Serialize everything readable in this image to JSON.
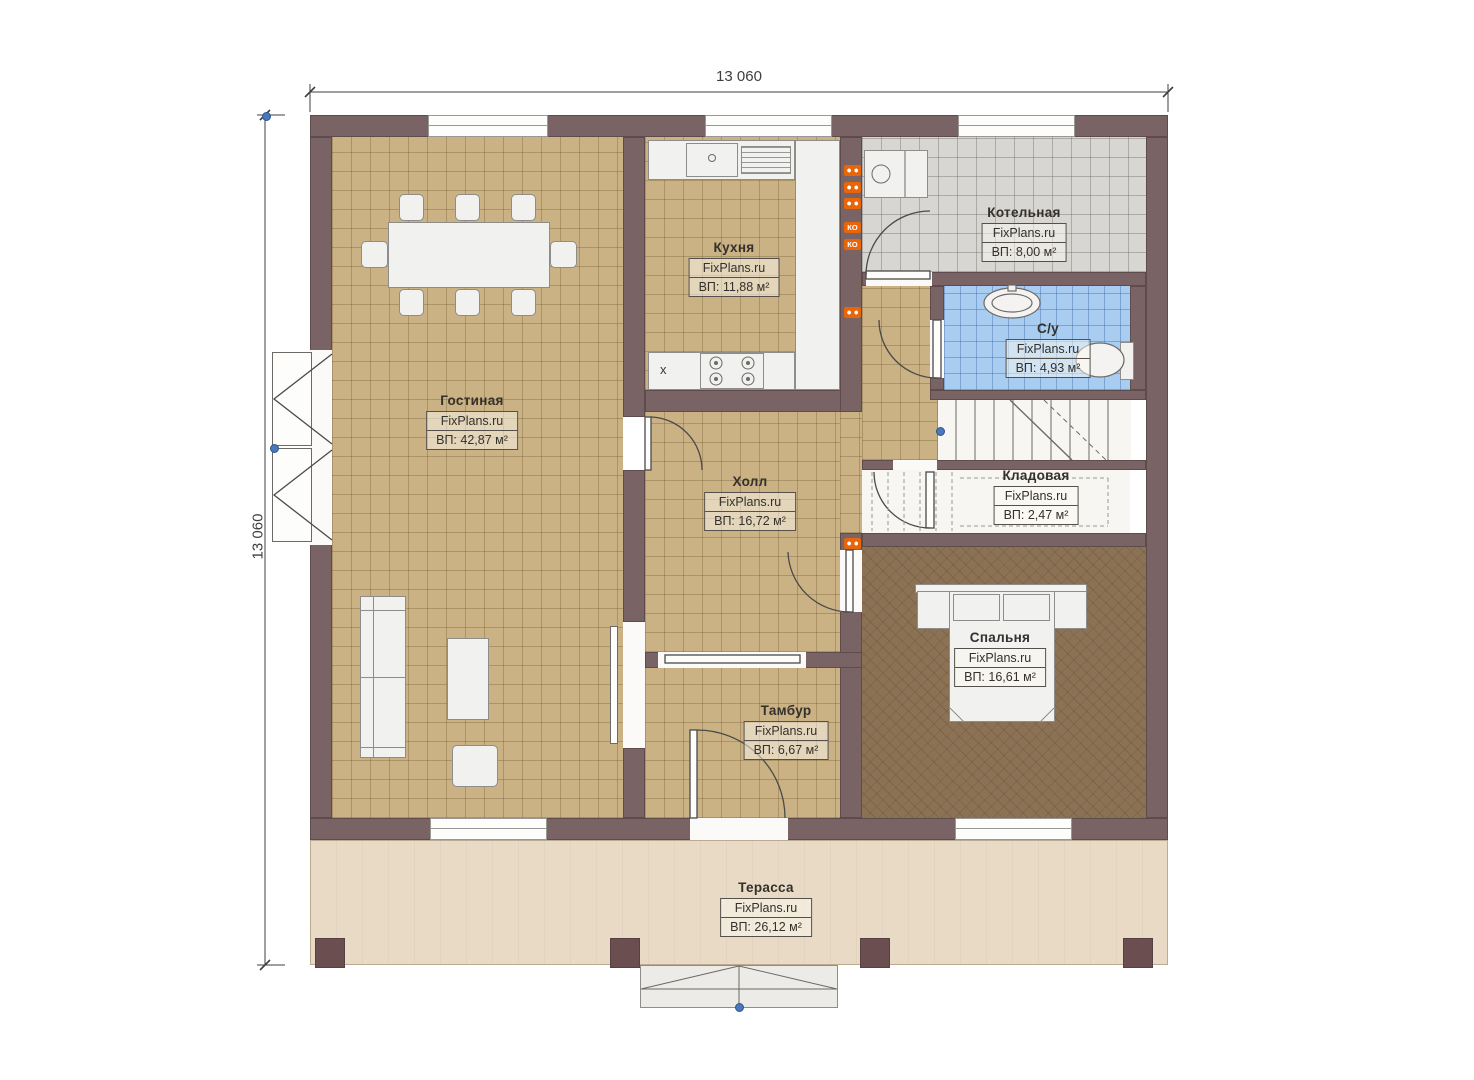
{
  "plan": {
    "dimensions": {
      "top": "13 060",
      "left": "13 060"
    },
    "rooms": [
      {
        "name": "Гостиная",
        "brand": "FixPlans.ru",
        "area": "ВП: 42,87 м²"
      },
      {
        "name": "Кухня",
        "brand": "FixPlans.ru",
        "area": "ВП: 11,88 м²"
      },
      {
        "name": "Котельная",
        "brand": "FixPlans.ru",
        "area": "ВП: 8,00 м²"
      },
      {
        "name": "С/у",
        "brand": "FixPlans.ru",
        "area": "ВП: 4,93 м²"
      },
      {
        "name": "Кладовая",
        "brand": "FixPlans.ru",
        "area": "ВП: 2,47 м²"
      },
      {
        "name": "Холл",
        "brand": "FixPlans.ru",
        "area": "ВП: 16,72 м²"
      },
      {
        "name": "Спальня",
        "brand": "FixPlans.ru",
        "area": "ВП: 16,61 м²"
      },
      {
        "name": "Тамбур",
        "brand": "FixPlans.ru",
        "area": "ВП: 6,67 м²"
      },
      {
        "name": "Терасса",
        "brand": "FixPlans.ru",
        "area": "ВП: 26,12 м²"
      }
    ],
    "annotations": {
      "outlet_label": "КО",
      "stove_symbol": "x"
    },
    "colors": {
      "wall": "#7a6364",
      "tile_tan": "#cab285",
      "tile_gray": "#d8d6d3",
      "tile_blue": "#a9cdf0",
      "carpet_brown": "#8b7254",
      "terrace": "#e8dac5",
      "outlet_orange": "#e8650a",
      "marker_blue": "#4a78b8"
    }
  }
}
